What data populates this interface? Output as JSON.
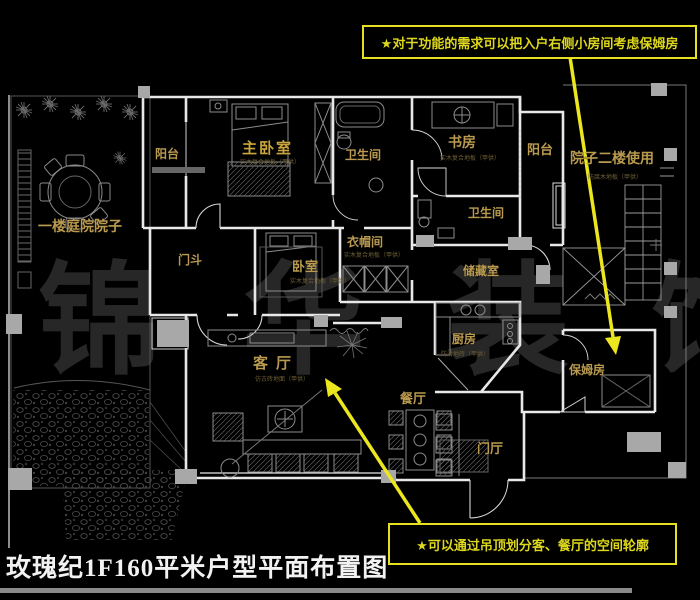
{
  "page": {
    "title": "玫瑰纪1F160平米户型平面布置图"
  },
  "watermark": "锦华装饰",
  "annotations": {
    "top_note": "★对于功能的需求可以把入户右侧小房间考虑保姆房",
    "bottom_note": "★可以通过吊顶划分客、餐厅的空间轮廓"
  },
  "colors": {
    "background": "#000000",
    "wall_white": "#e8e8e8",
    "label_gold": "#b99a4f",
    "annotation_yellow": "#e6e01e",
    "arrow_yellow": "#ece61f",
    "title_white": "#f2f2f2",
    "watermark_gray": "#272727",
    "furniture_gray": "#8c8c8c"
  },
  "rooms": [
    {
      "name": "阳台",
      "sub": ""
    },
    {
      "name": "主卧室",
      "sub": "实木复合地板（甲供）"
    },
    {
      "name": "卫生间",
      "sub": ""
    },
    {
      "name": "书房",
      "sub": "实木复合地板（甲供）"
    },
    {
      "name": "阳台",
      "sub": ""
    },
    {
      "name": "院子二楼使用",
      "sub": "防腐木地板（甲供）"
    },
    {
      "name": "一楼庭院院子",
      "sub": ""
    },
    {
      "name": "门斗",
      "sub": ""
    },
    {
      "name": "卧室",
      "sub": "实木复合地板（甲供）"
    },
    {
      "name": "衣帽间",
      "sub": "实木复合地板（甲供）"
    },
    {
      "name": "卫生间",
      "sub": ""
    },
    {
      "name": "储藏室",
      "sub": ""
    },
    {
      "name": "厨房",
      "sub": "防滑地砖（甲供）"
    },
    {
      "name": "客厅",
      "sub": "仿古砖地面（甲供）"
    },
    {
      "name": "餐厅",
      "sub": ""
    },
    {
      "name": "门厅",
      "sub": ""
    },
    {
      "name": "保姆房",
      "sub": ""
    }
  ]
}
